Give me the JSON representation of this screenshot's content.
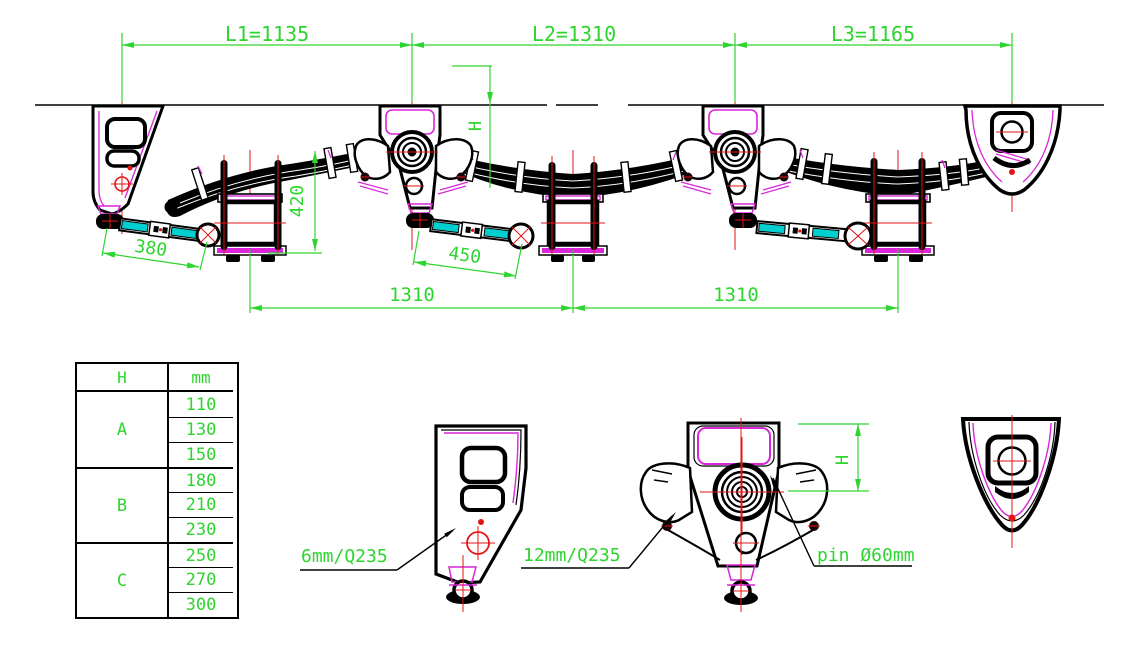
{
  "drawing_dimensions": {
    "l1": "L1=1135",
    "l2": "L2=1310",
    "l3": "L3=1165",
    "axle_spacing_1": "1310",
    "axle_spacing_2": "1310",
    "spring_height": "420",
    "torque_arm_1": "380",
    "torque_arm_2": "450",
    "ride_height": "H",
    "detail_ride_height": "H"
  },
  "callouts": {
    "front_hanger_plate": "6mm/Q235",
    "equalizer_plate": "12mm/Q235",
    "equalizer_pin": "pin Ø60mm"
  },
  "table": {
    "col1_header": "H",
    "col2_header": "mm",
    "groups": [
      {
        "label": "A",
        "values": [
          "110",
          "130",
          "150"
        ]
      },
      {
        "label": "B",
        "values": [
          "180",
          "210",
          "230"
        ]
      },
      {
        "label": "C",
        "values": [
          "250",
          "270",
          "300"
        ]
      }
    ]
  },
  "colors": {
    "dimension_green": "#2ed52e",
    "outline_black": "#000000",
    "centerline_red": "#e41414",
    "accent_magenta": "#d926d9",
    "torque_arm_cyan": "#00cfcf"
  }
}
